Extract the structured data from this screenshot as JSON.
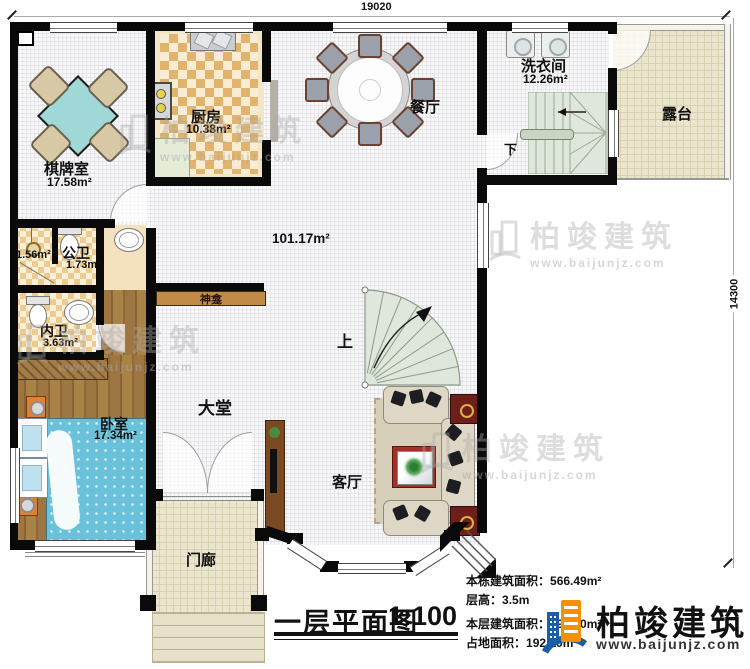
{
  "dimensions": {
    "top": "19020",
    "right": "14300"
  },
  "rooms": {
    "qipaishi": {
      "name": "棋牌室",
      "area": "17.58m²"
    },
    "chufang": {
      "name": "厨房",
      "area": "10.38m²"
    },
    "canting": {
      "name": "餐厅"
    },
    "xiyijian": {
      "name": "洗衣间",
      "area": "12.26m²"
    },
    "lutai": {
      "name": "露台"
    },
    "hall": {
      "area": "101.17m²"
    },
    "gongwei": {
      "name": "公卫",
      "area": "1.73m²"
    },
    "linyu": {
      "area": "1.56m²"
    },
    "neiwei": {
      "name": "内卫",
      "area": "3.63m²"
    },
    "woshi": {
      "name": "卧室",
      "area": "17.34m²"
    },
    "datang": {
      "name": "大堂"
    },
    "keting": {
      "name": "客厅"
    },
    "menlang": {
      "name": "门廊"
    },
    "shenkan": {
      "name": "神龛"
    }
  },
  "stairs": {
    "up": "上",
    "down": "下"
  },
  "title_block": {
    "plan_title": "一层平面图",
    "scale": "1:100",
    "total_area_label": "本栋建筑面积：",
    "total_area": "566.49m²",
    "floor_height_label": "层高：",
    "floor_height": "3.5m",
    "floor_area_label": "本层建筑面积：",
    "floor_area": "192.10m²",
    "footprint_label": "占地面积：",
    "footprint": "192.10m²"
  },
  "brand": {
    "name": "柏竣建筑",
    "website": "www.baijunjz.com"
  },
  "watermark": {
    "name": "柏竣建筑",
    "website": "www.baijunjz.com"
  },
  "colors": {
    "wall": "#0a0a0a",
    "brand_blue": "#1b5ea6",
    "brand_orange": "#f29200",
    "bed": "#6ac2da",
    "mahjong_table": "#9fd8d6",
    "stair": "#dfe6db"
  }
}
